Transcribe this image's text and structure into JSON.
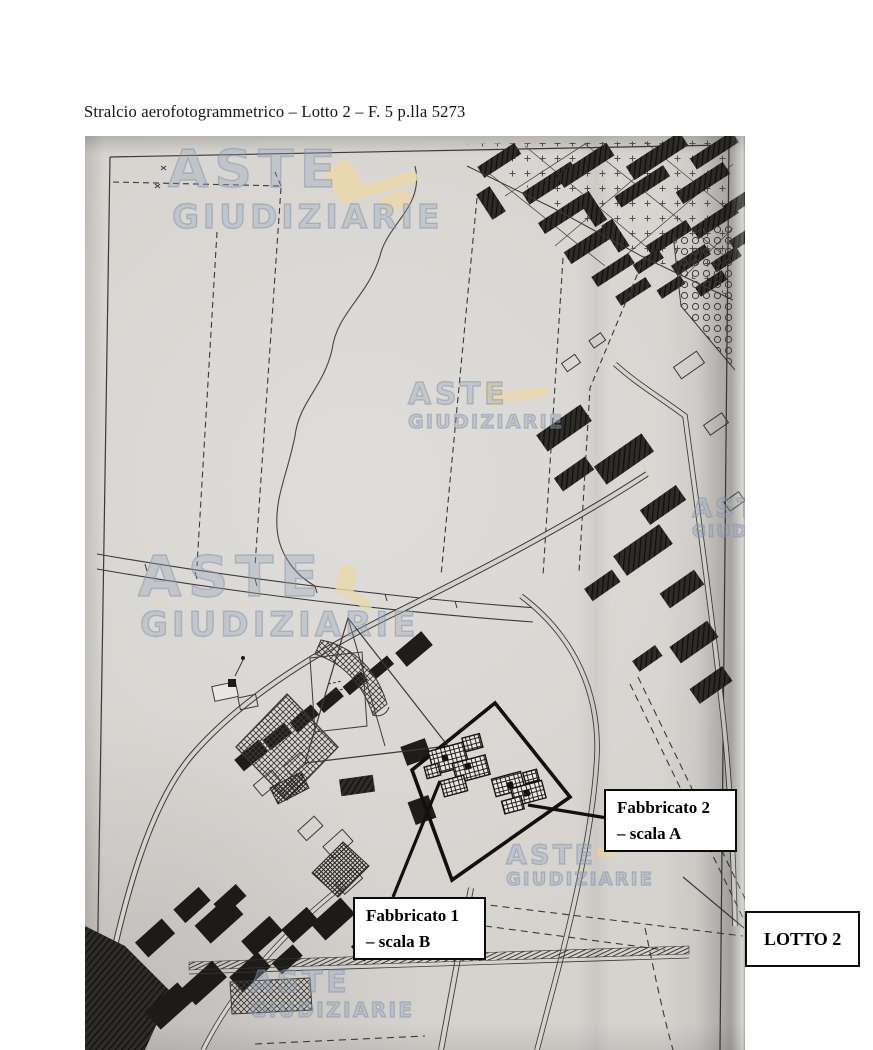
{
  "page": {
    "title": "Stralcio aerofotogrammetrico – Lotto 2 – F. 5 p.lla 5273"
  },
  "watermark": {
    "line1": "ASTE",
    "line2": "GIUDIZIARIE",
    "gavel_icon": "gavel-icon"
  },
  "annotations": {
    "fabbricato2_line1": "Fabbricato 2",
    "fabbricato2_line2": "– scala A",
    "fabbricato1_line1": "Fabbricato 1",
    "fabbricato1_line2": "– scala B",
    "lotto": "LOTTO 2"
  },
  "colors": {
    "scan_background": "#d6d3cf",
    "map_ink": "#3b3935",
    "lot_boundary": "#12100e",
    "watermark": "#96a2b8",
    "gavel": "#ead9ad",
    "label_border": "#0b0b0b"
  }
}
